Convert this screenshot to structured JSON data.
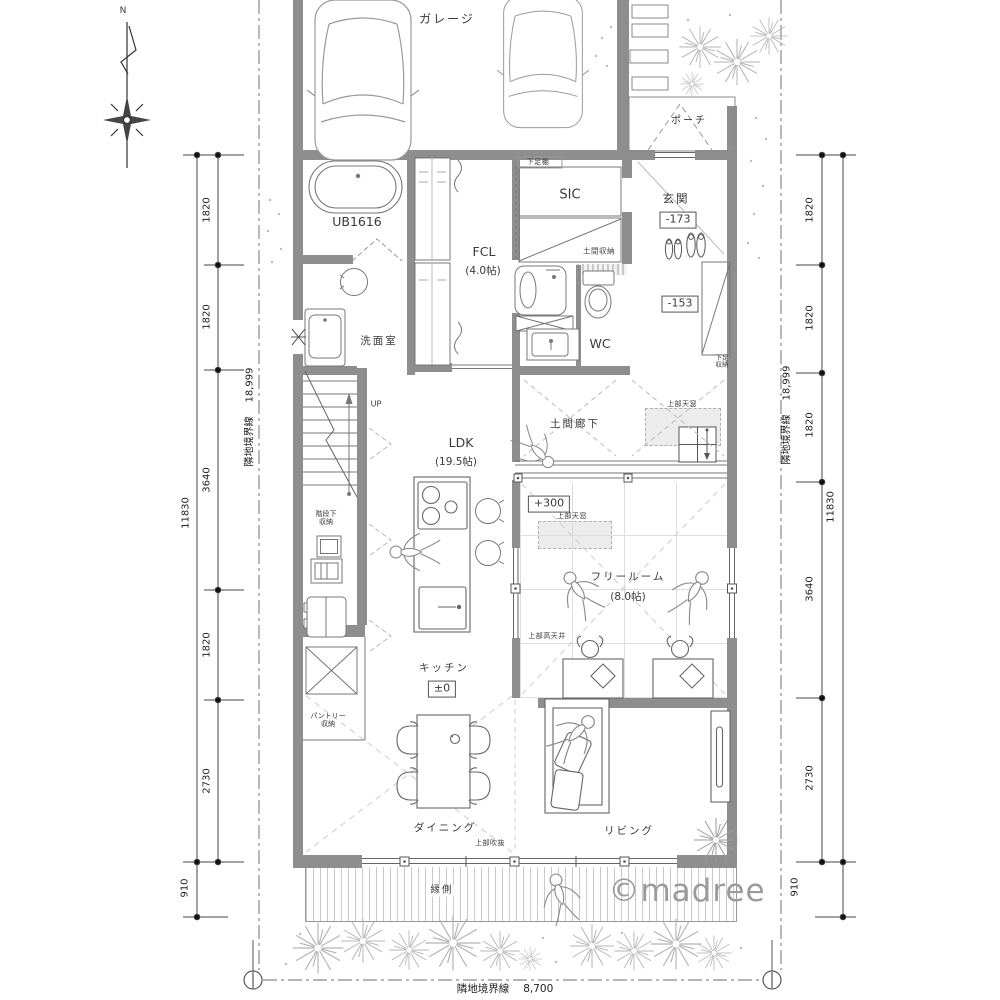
{
  "compass": {
    "north": "N"
  },
  "site": {
    "garage": "ガレージ",
    "porch": "ポーチ",
    "watermark": "©madree"
  },
  "rooms": {
    "bath": "UB1616",
    "sic": "SIC",
    "entrance": "玄関",
    "washroom": "洗面室",
    "fcl": "FCL",
    "fcl_size": "(4.0帖)",
    "wc": "WC",
    "doma_corridor": "土間廊下",
    "ldk": "LDK",
    "ldk_size": "(19.5帖)",
    "free_room": "フリールーム",
    "free_room_size": "(8.0帖)",
    "kitchen": "キッチン",
    "dining": "ダイニング",
    "living": "リビング",
    "engawa": "縁側"
  },
  "levels": {
    "entrance": "-173",
    "hall": "-153",
    "free_room": "+300",
    "kitchen": "±0"
  },
  "annotations": {
    "up": "UP",
    "shoe_shelf": "下足棚",
    "doma_storage": "土間収納",
    "shoe_storage_line1": "下足",
    "shoe_storage_line2": "収納",
    "stair_storage_line1": "階段下",
    "stair_storage_line2": "収納",
    "pantry_line1": "パントリー",
    "pantry_line2": "収納",
    "skylight_hall": "上部天窓",
    "skylight_free_room": "上部天窓",
    "high_ceiling": "上部高天井",
    "open_above": "上部吹抜"
  },
  "dimensions": {
    "left": {
      "segments": [
        "1820",
        "1820",
        "3640",
        "1820",
        "2730"
      ],
      "total": "11830",
      "engawa": "910",
      "boundary_label": "隣地境界線",
      "boundary_value": "18,999"
    },
    "right": {
      "segments": [
        "1820",
        "1820",
        "1820",
        "3640",
        "2730"
      ],
      "total": "11830",
      "engawa": "910",
      "boundary_label": "隣地境界線",
      "boundary_value": "18,999"
    },
    "bottom": {
      "boundary_label": "隣地境界線",
      "boundary_value": "8,700"
    }
  }
}
